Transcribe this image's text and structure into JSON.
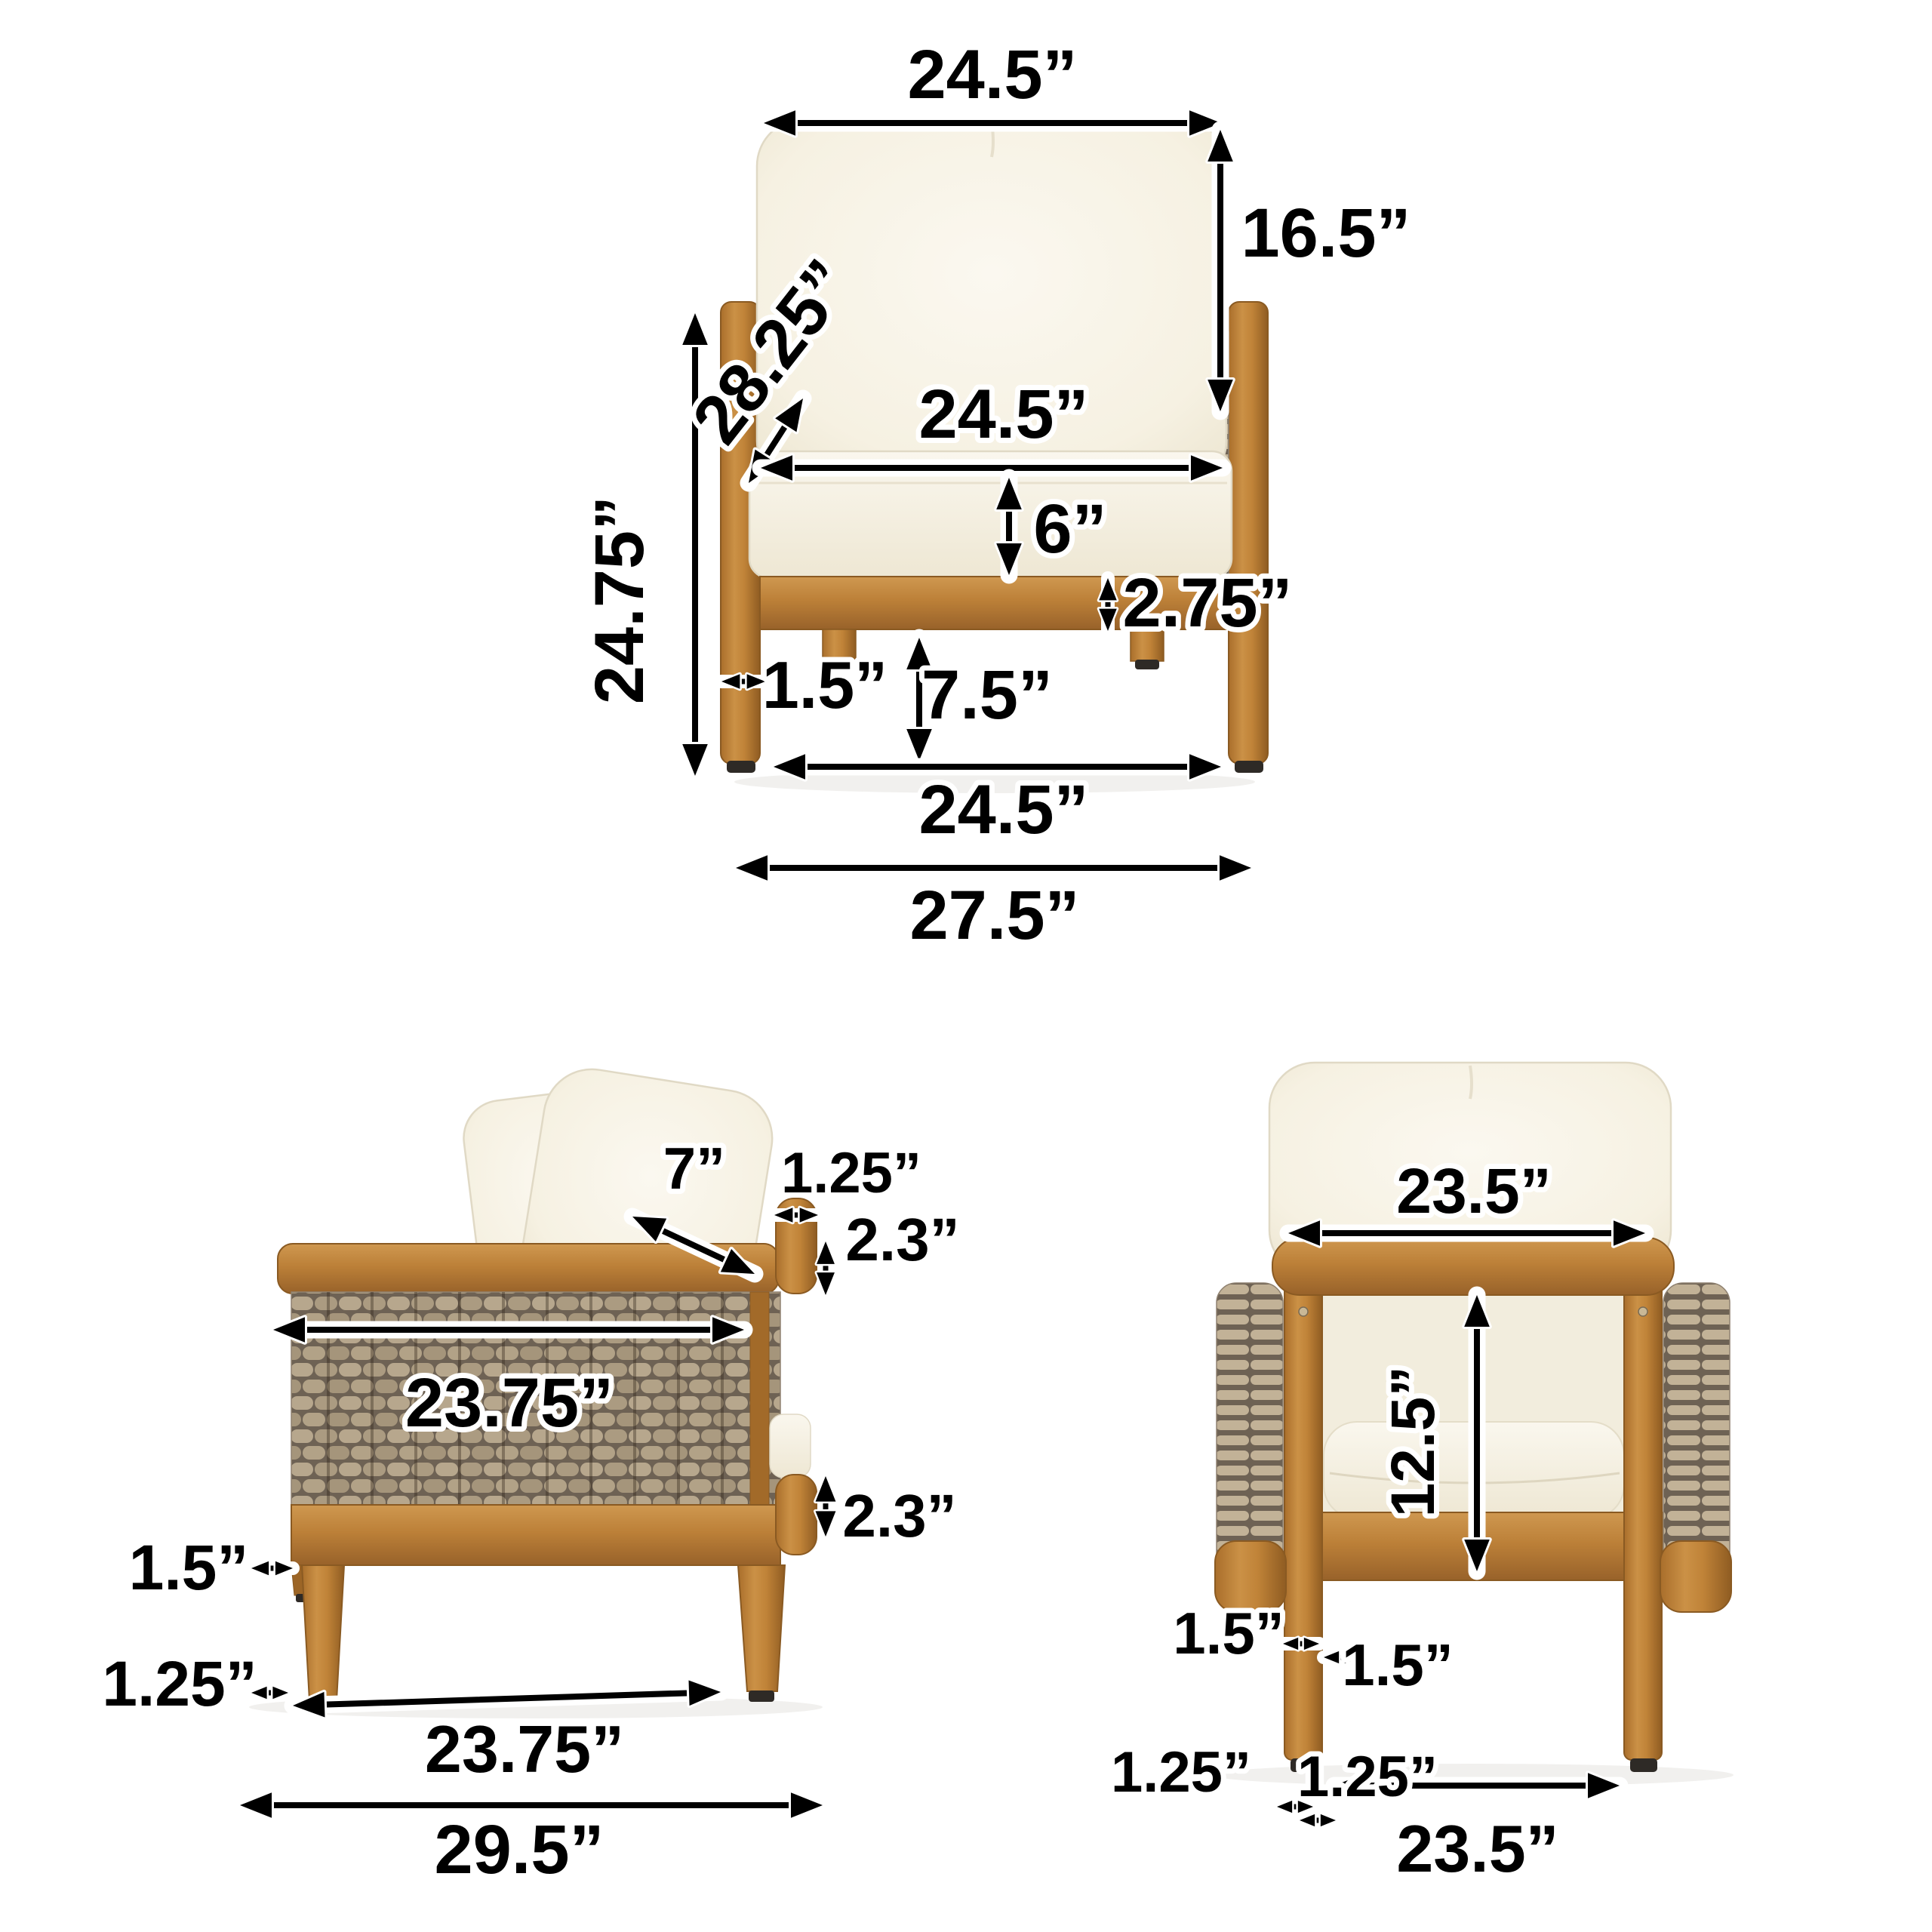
{
  "page": {
    "background": "#ffffff",
    "description": "Three-view dimension diagram of an outdoor acacia wood and wicker club chair with white cushions"
  },
  "colors": {
    "wood": "#c08139",
    "wood_dark_edge": "#8a5a22",
    "wood_light": "#cf9850",
    "wicker": "#b7a78d",
    "wicker_gap": "#6e6254",
    "cushion": "#f7f3e8",
    "cushion_edge": "#e0d9c5",
    "dimension_line": "#000000",
    "label_halo": "#ffffff",
    "foot_pad": "#2e2a26",
    "shadow": "#f0efed"
  },
  "views": {
    "front": {
      "label": "front-view",
      "dims": {
        "back_pillow_width": "24.5”",
        "back_pillow_height": "16.5”",
        "arm_height": "28.25”",
        "total_height": "24.75”",
        "seat_width": "24.5”",
        "seat_cushion_thickness": "6”",
        "seat_rail_height": "2.75”",
        "leg_width": "1.5”",
        "under_seat_clearance": "7.5”",
        "leg_span_width": "24.5”",
        "overall_width": "27.5”"
      }
    },
    "side": {
      "label": "side-view",
      "dims": {
        "pillow_depth": "7”",
        "rim_overhang": "1.25”",
        "rim_top_thickness": "2.3”",
        "frame_depth_top": "23.75”",
        "rim_bottom_thickness": "2.3”",
        "leg_width": "1.5”",
        "foot_width": "1.25”",
        "leg_span_depth": "23.75”",
        "overall_depth": "29.5”"
      }
    },
    "back": {
      "label": "back-view",
      "dims": {
        "back_width": "23.5”",
        "back_opening_height": "12.5”",
        "leg_width_a": "1.5”",
        "leg_width_b": "1.5”",
        "foot_width_a": "1.25”",
        "foot_width_b": "1.25”",
        "leg_span_width": "23.5”"
      }
    }
  }
}
